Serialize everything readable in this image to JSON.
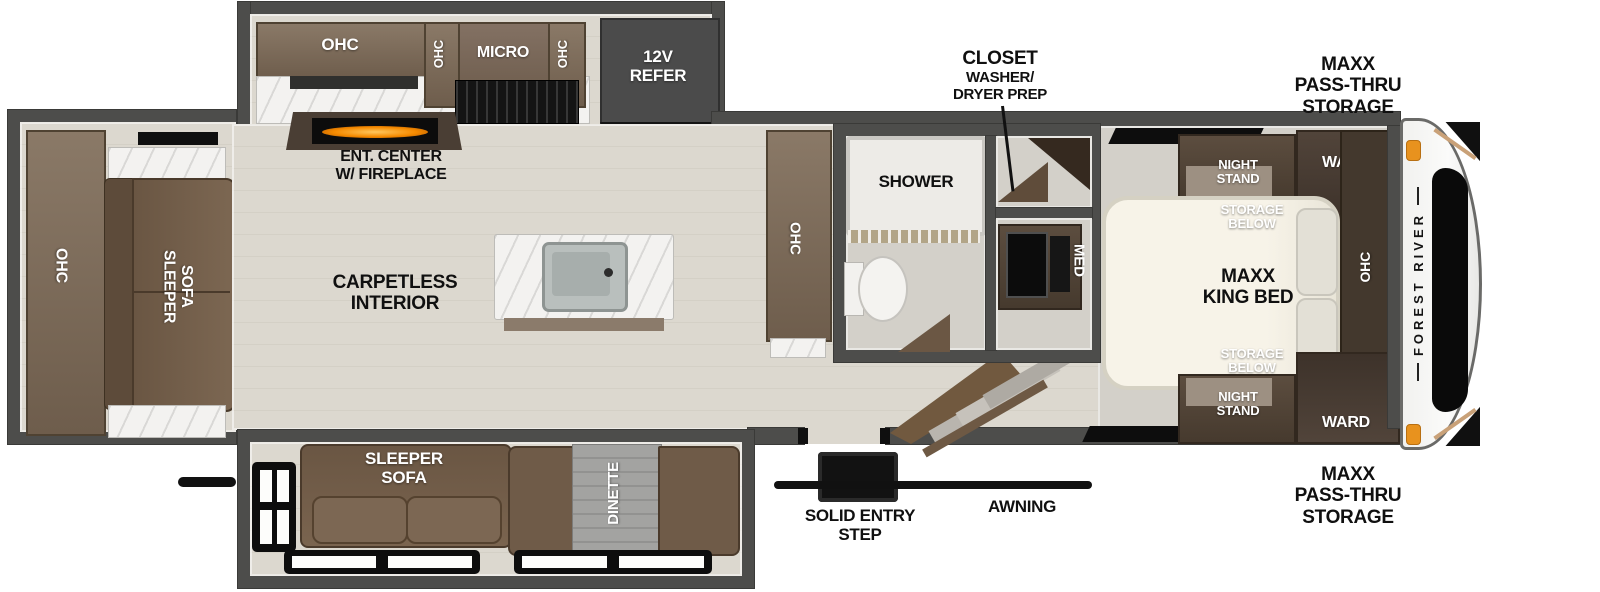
{
  "labels": {
    "rear_ohc": "OHC",
    "rear_sleeper_sofa": "SLEEPER\nSOFA",
    "kitchen_ohc_main": "OHC",
    "kitchen_ohc_small_left": "OHC",
    "kitchen_micro": "MICRO",
    "kitchen_ohc_small_right": "OHC",
    "kitchen_refer": "12V\nREFER",
    "ent_center": "ENT. CENTER\nW/ FIREPLACE",
    "carpetless_interior": "CARPETLESS\nINTERIOR",
    "pantry_ohc": "OHC",
    "shower": "SHOWER",
    "med_cabinet": "MED",
    "closet_title": "CLOSET",
    "closet_subtitle": "WASHER/\nDRYER PREP",
    "bottom_sleeper_sofa": "SLEEPER\nSOFA",
    "dinette": "DINETTE",
    "solid_entry_step": "SOLID ENTRY\nSTEP",
    "awning": "AWNING",
    "storage_front_top": "MAXX\nPASS-THRU\nSTORAGE",
    "storage_front_bottom": "MAXX\nPASS-THRU\nSTORAGE",
    "night_stand_top": "NIGHT\nSTAND",
    "night_stand_bottom": "NIGHT\nSTAND",
    "ward_top": "WARD",
    "ward_bottom": "WARD",
    "storage_below_top": "STORAGE\nBELOW",
    "storage_below_bottom": "STORAGE\nBELOW",
    "king_bed": "MAXX\nKING BED",
    "bedroom_ohc": "OHC",
    "brand": "FOREST RIVER"
  },
  "colors": {
    "wall": "#4d4d4b",
    "floor_living": "#dcd8cf",
    "floor_bedroom": "#d3d0c9",
    "cabinet_brown": "#7c6b5a",
    "cabinet_dark": "#5a4a3c",
    "sofa_brown": "#6f5b48",
    "marker_light_orange": "#e8921e",
    "fireplace_glow": "#f58a00",
    "awning_black": "#111111"
  }
}
